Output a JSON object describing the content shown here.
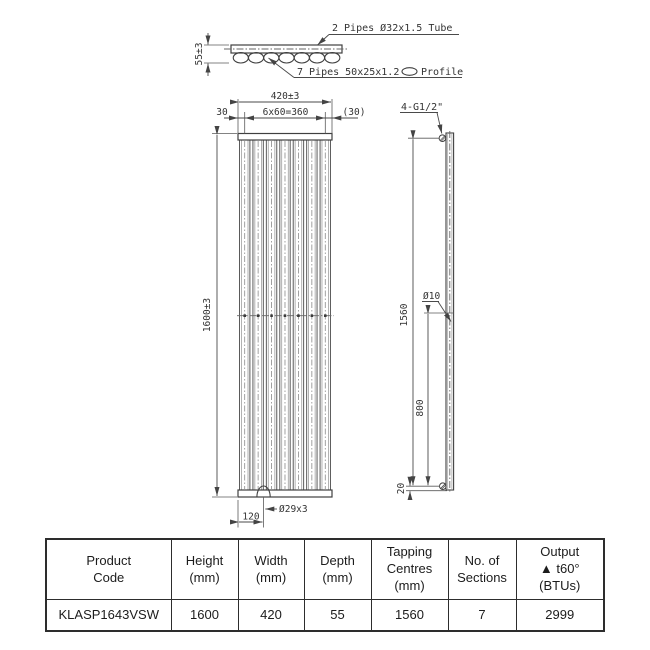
{
  "drawing": {
    "sections": 7,
    "top_view": {
      "tube_label": "2 Pipes Ø32x1.5 Tube",
      "profile_label_left": "7 Pipes 50x25x1.2",
      "profile_label_right": "Profile",
      "depth_dim": "55±3"
    },
    "front_view": {
      "width_dim": "420±3",
      "left_margin_dim": "30",
      "spacing_dim": "6x60=360",
      "right_margin_dim": "(30)",
      "height_dim": "1600±3",
      "hole_dim": "Ø29x3",
      "hole_offset_dim": "120"
    },
    "side_view": {
      "tapping_label": "4-G1/2\"",
      "tapping_centres_dim": "1560",
      "bracket_dim": "800",
      "hole_dim": "Ø10",
      "bottom_offset_dim": "20"
    },
    "line_color": "#3f3f3f"
  },
  "table": {
    "headers": [
      "Product\nCode",
      "Height\n(mm)",
      "Width\n(mm)",
      "Depth\n(mm)",
      "Tapping\nCentres\n(mm)",
      "No. of\nSections",
      "Output\n▲ t60° (BTUs)"
    ],
    "row": [
      "KLASP1643VSW",
      "1600",
      "420",
      "55",
      "1560",
      "7",
      "2999"
    ]
  }
}
